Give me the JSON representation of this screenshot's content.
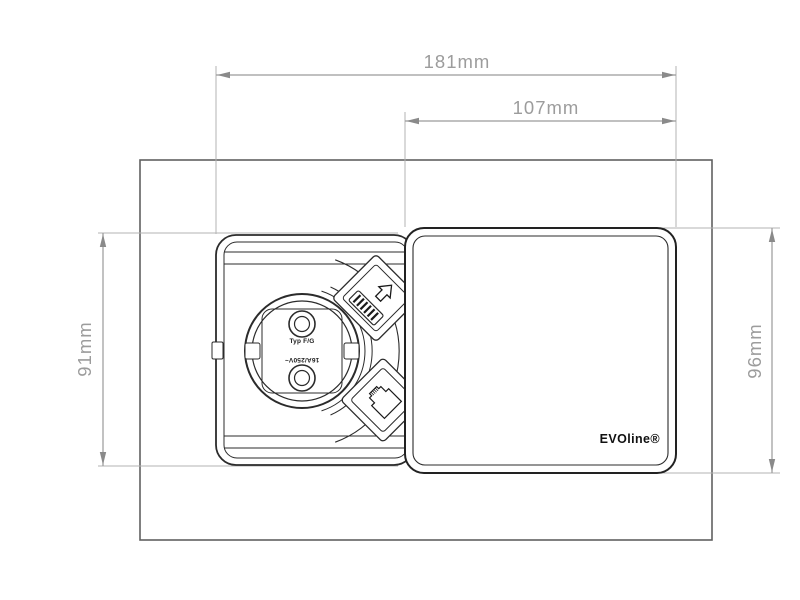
{
  "drawing": {
    "dimensions": {
      "total_width": "181mm",
      "cover_width": "107mm",
      "unit_height": "91mm",
      "cover_height": "96mm"
    },
    "socket": {
      "type_label": "Typ F/G",
      "rating_label": "16A/250V~"
    },
    "cover": {
      "brand_label": "EVOline®"
    },
    "icons": [
      "charge-arrow-icon",
      "usb-port-icon",
      "rj45-jack-icon",
      "schuko-outlet"
    ],
    "colors": {
      "outline_dark": "#2b2b2b",
      "cutout_outline": "#606060",
      "dimension_lines": "#9a9a9a",
      "dimension_text": "#9c9c9c",
      "background": "#ffffff"
    }
  }
}
